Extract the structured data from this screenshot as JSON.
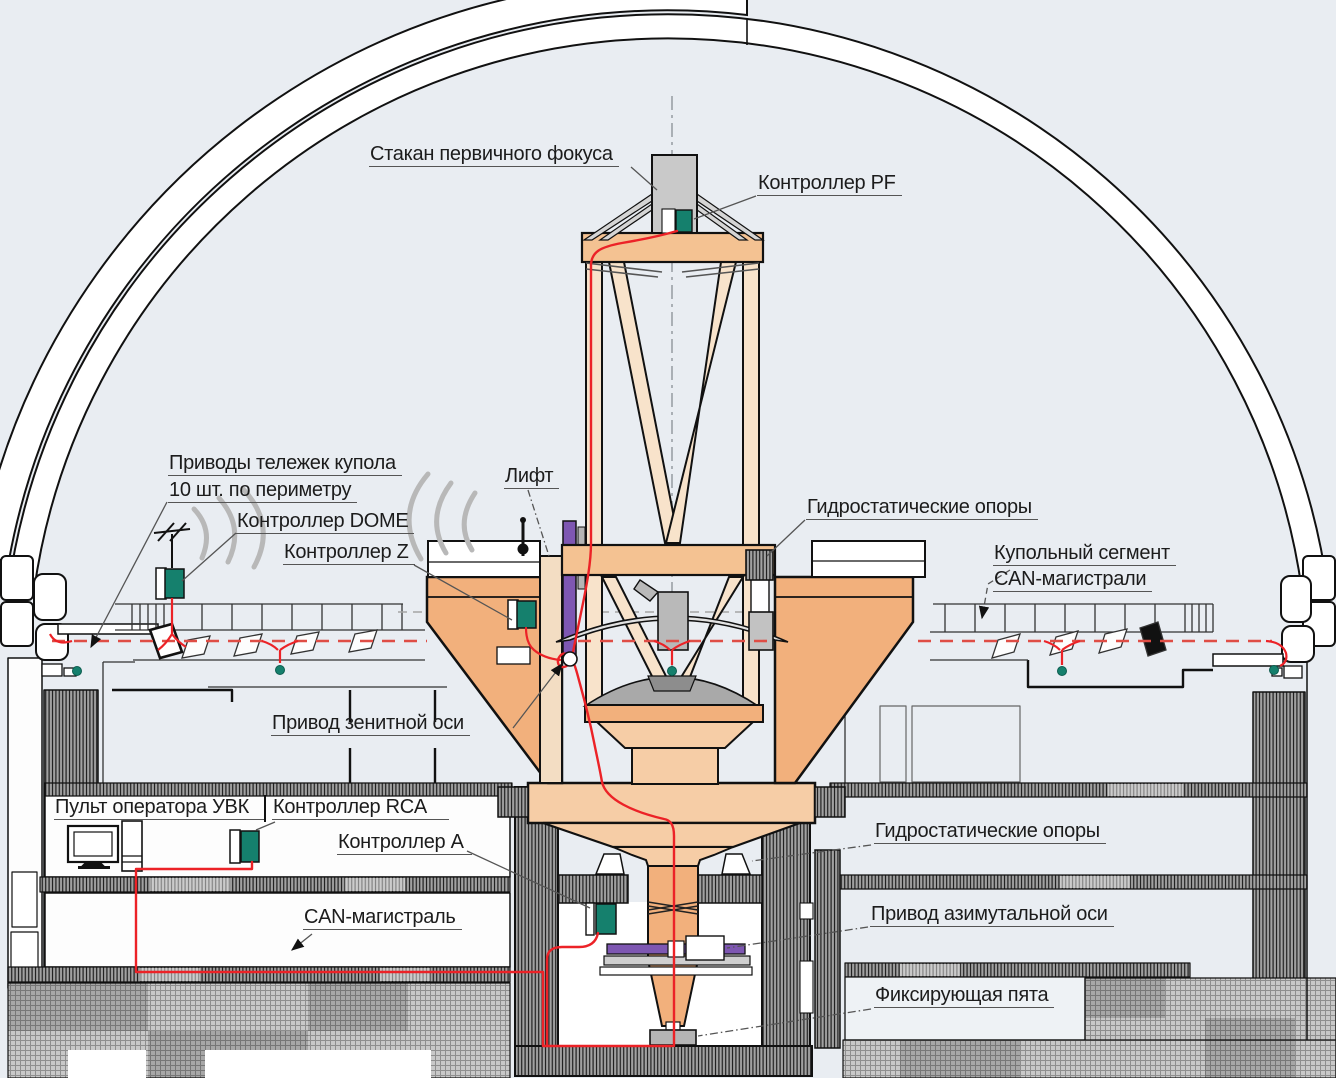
{
  "diagram": {
    "title": "Схема системы управления телескопа в куполе",
    "labels": {
      "primary_focus": "Стакан первичного фокуса",
      "controller_pf": "Контроллер PF",
      "dome_drives_1": "Приводы тележек купола",
      "dome_drives_2": "10 шт. по периметру",
      "controller_dome": "Контроллер DOME",
      "controller_z": "Контроллер Z",
      "lift": "Лифт",
      "hydrostatic_upper": "Гидростатические опоры",
      "dome_segment_1": "Купольный сегмент",
      "dome_segment_2": "CAN-магистрали",
      "zenith_drive": "Привод зенитной оси",
      "operator_console": "Пульт оператора УВК",
      "controller_rca": "Контроллер RCA",
      "controller_a": "Контроллер А",
      "can_bus": "CAN-магистраль",
      "hydrostatic_lower": "Гидростатические опоры",
      "azimuth_drive": "Привод азимутальной оси",
      "fixing_heel": "Фиксирующая пята"
    },
    "colors": {
      "background": "#e9edf2",
      "outline": "#111111",
      "truss_tan": "#f8e3cb",
      "fork_orange": "#f2b07c",
      "platform_orange": "#f6cda6",
      "ring_orange": "#f4c292",
      "cable_red": "#ec2227",
      "can_dashed_red": "#df4d45",
      "controller_teal": "#15806d",
      "drive_purple": "#7e57b2",
      "metal_gray": "#c9c9c9",
      "leader_gray": "#555555",
      "wireless_gray": "#b8b8b8"
    }
  }
}
